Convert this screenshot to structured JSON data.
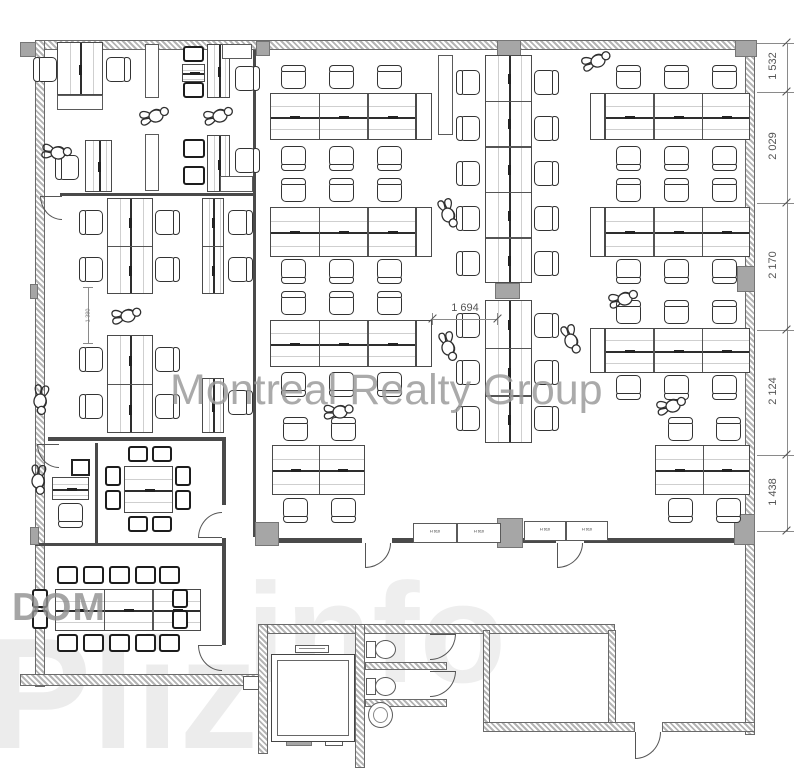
{
  "watermarks": {
    "main": "Montreal Realty Group",
    "dom": "DOM",
    "big_left": "Pliz",
    "big_right": "info"
  },
  "dimensions": {
    "right": [
      "1 532",
      "2 029",
      "2 170",
      "2 124",
      "1 438"
    ],
    "center": "1 694",
    "left": "1 380"
  },
  "labels": {
    "cabinet": "H 910"
  },
  "colors": {
    "line": "#4a4a4a",
    "hatch": "#b4b4b4",
    "column": "#a6a6a6",
    "watermark_gray": "#9c9c9c",
    "watermark_light": "rgba(0,0,0,0.07)"
  }
}
